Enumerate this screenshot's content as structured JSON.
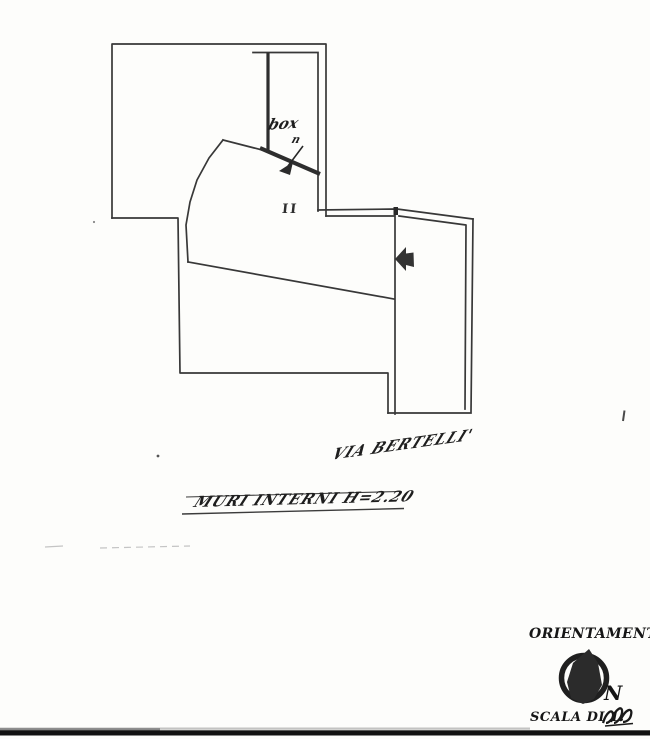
{
  "plan": {
    "box_label": "box",
    "box_number": "n",
    "room_mark": "II",
    "street_name": "VIA BERTELLI'",
    "internal_walls_note": "MURI INTERNI H=2.20"
  },
  "orientation": {
    "title": "ORIENTAMENTO",
    "north": "N"
  },
  "scale": {
    "label": "SCALA DI 1."
  },
  "colors": {
    "ink": "#383838",
    "handwriting": "#1e1e1e",
    "scan_bar": "#111111",
    "faint_marks": "#c4c4c4",
    "background": "#fdfdfb"
  }
}
